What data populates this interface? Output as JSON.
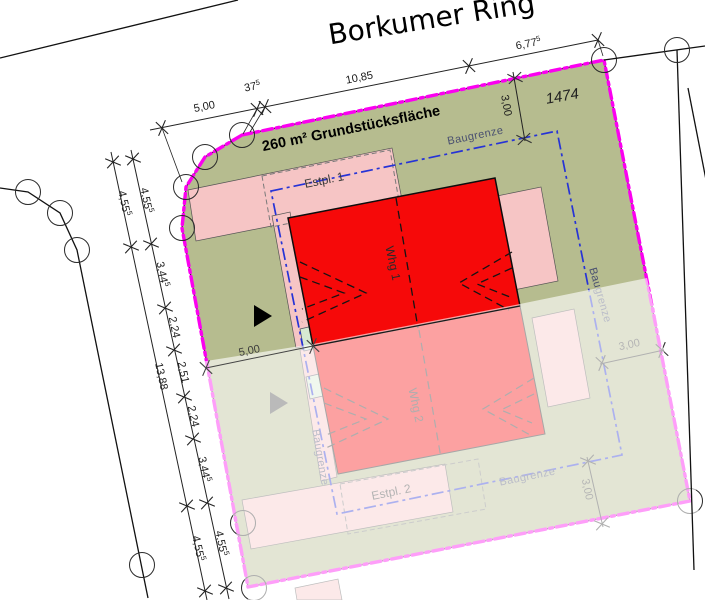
{
  "street": {
    "name": "Borkumer Ring"
  },
  "parcel": {
    "area_label": "260 m² Grundstücksfläche",
    "number": "1474"
  },
  "buildings": {
    "whg1": "Whg 1",
    "whg2": "Whg 2"
  },
  "parking": {
    "estpl1": "Estpl. 1",
    "estpl2": "Estpl. 2"
  },
  "boundary_labels": {
    "baugrenze_top": "Baugrenze",
    "baugrenze_right": "Baugrenze",
    "baugrenze_bottom": "Baugrenze",
    "baugrenze_left": "Baugrenze"
  },
  "dims": {
    "top": [
      {
        "v": "5,00",
        "s": ""
      },
      {
        "v": "37",
        "s": "5"
      },
      {
        "v": "10,85",
        "s": ""
      },
      {
        "v": "6,77",
        "s": "5"
      }
    ],
    "left_outer": [
      {
        "v": "4,55",
        "s": "5"
      },
      {
        "v": "13,88",
        "s": ""
      },
      {
        "v": "4,55",
        "s": "5"
      }
    ],
    "left_inner": [
      {
        "v": "4,55",
        "s": "5"
      },
      {
        "v": "3,44",
        "s": "5"
      },
      {
        "v": "2,24",
        "s": ""
      },
      {
        "v": "2,51",
        "s": ""
      },
      {
        "v": "2,24",
        "s": ""
      },
      {
        "v": "3,44",
        "s": "5"
      },
      {
        "v": "4,55",
        "s": "5"
      }
    ],
    "setback_top": {
      "v": "3,00",
      "s": ""
    },
    "setback_right": {
      "v": "3,00",
      "s": ""
    },
    "setback_bottom": {
      "v": "3,00",
      "s": ""
    },
    "party_wall": {
      "v": "5,00",
      "s": ""
    }
  },
  "colors": {
    "site_boundary": "#fb00f0",
    "baugrenze_line": "#2633d6",
    "parcel_fill": "#b6bc8f",
    "building_fill": "#f60909",
    "annex_fill": "#f6c5c5",
    "entry_fill": "#d7e9d2",
    "fade_overlay": "rgba(255,255,255,0.62)"
  }
}
